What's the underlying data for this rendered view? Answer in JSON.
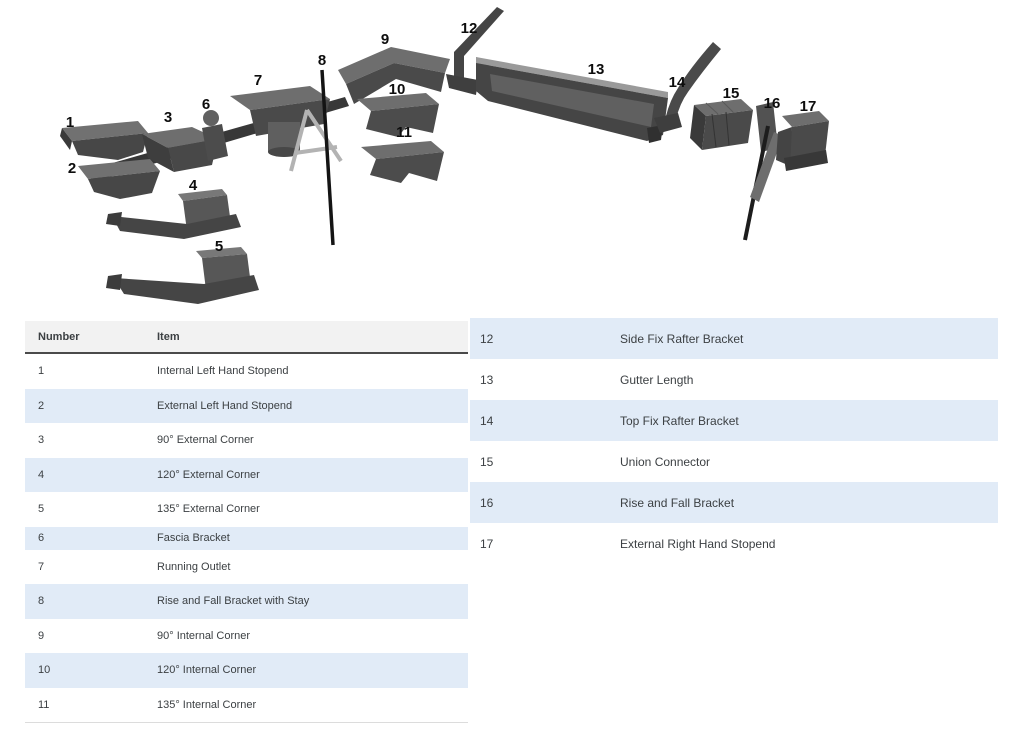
{
  "diagram": {
    "labels": [
      "1",
      "2",
      "3",
      "4",
      "5",
      "6",
      "7",
      "8",
      "9",
      "10",
      "11",
      "12",
      "13",
      "14",
      "15",
      "16",
      "17"
    ]
  },
  "left_table": {
    "headers": {
      "number": "Number",
      "item": "Item"
    },
    "rows": [
      {
        "number": "1",
        "item": "Internal Left Hand Stopend"
      },
      {
        "number": "2",
        "item": "External Left Hand Stopend"
      },
      {
        "number": "3",
        "item": "90° External Corner"
      },
      {
        "number": "4",
        "item": "120° External Corner"
      },
      {
        "number": "5",
        "item": "135° External Corner"
      },
      {
        "number": "6",
        "item": "Fascia Bracket"
      },
      {
        "number": "7",
        "item": "Running Outlet"
      },
      {
        "number": "8",
        "item": "Rise and Fall Bracket with Stay"
      },
      {
        "number": "9",
        "item": "90° Internal Corner"
      },
      {
        "number": "10",
        "item": "120° Internal Corner"
      },
      {
        "number": "11",
        "item": "135° Internal Corner"
      }
    ]
  },
  "right_table": {
    "rows": [
      {
        "number": "12",
        "item": "Side Fix Rafter Bracket"
      },
      {
        "number": "13",
        "item": "Gutter Length"
      },
      {
        "number": "14",
        "item": "Top Fix Rafter Bracket"
      },
      {
        "number": "15",
        "item": "Union Connector"
      },
      {
        "number": "16",
        "item": "Rise and Fall Bracket"
      },
      {
        "number": "17",
        "item": "External Right Hand Stopend"
      }
    ]
  },
  "colors": {
    "row_highlight": "#e1ebf7",
    "header_bg": "#f2f2f2",
    "text": "#3c4043",
    "part_dark": "#454545",
    "part_light": "#6e6e6e"
  }
}
